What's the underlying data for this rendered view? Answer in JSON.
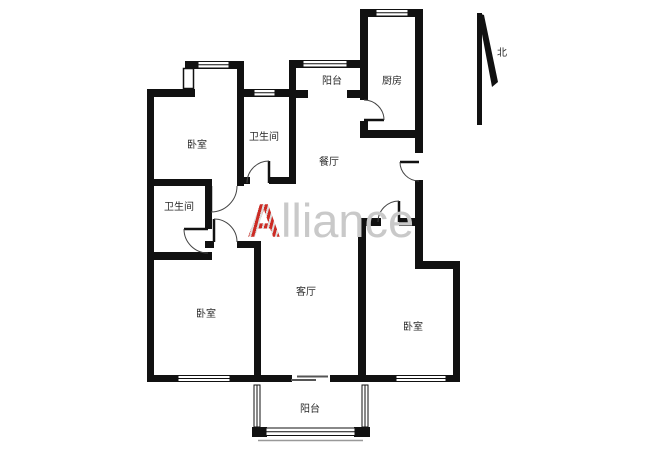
{
  "floorplan": {
    "background": "#ffffff",
    "wall_color": "#111111",
    "labels": [
      {
        "id": "bedroom-top-left",
        "text": "卧室",
        "x": 197,
        "y": 148
      },
      {
        "id": "bathroom-top",
        "text": "卫生间",
        "x": 264,
        "y": 140
      },
      {
        "id": "balcony-top",
        "text": "阳台",
        "x": 332,
        "y": 84
      },
      {
        "id": "kitchen",
        "text": "厨房",
        "x": 392,
        "y": 84
      },
      {
        "id": "dining-room",
        "text": "餐厅",
        "x": 329,
        "y": 165
      },
      {
        "id": "bathroom-left",
        "text": "卫生间",
        "x": 179,
        "y": 210
      },
      {
        "id": "bedroom-bottom-left",
        "text": "卧室",
        "x": 206,
        "y": 317
      },
      {
        "id": "living-room",
        "text": "客厅",
        "x": 306,
        "y": 295
      },
      {
        "id": "bedroom-right",
        "text": "卧室",
        "x": 413,
        "y": 330
      },
      {
        "id": "balcony-bottom",
        "text": "阳台",
        "x": 310,
        "y": 412
      }
    ],
    "compass": {
      "label": "北"
    },
    "watermark": {
      "first_letter": "A",
      "rest": "lliance",
      "accent_color": "#cc2b24",
      "gray_color": "#c9c9c9"
    }
  }
}
